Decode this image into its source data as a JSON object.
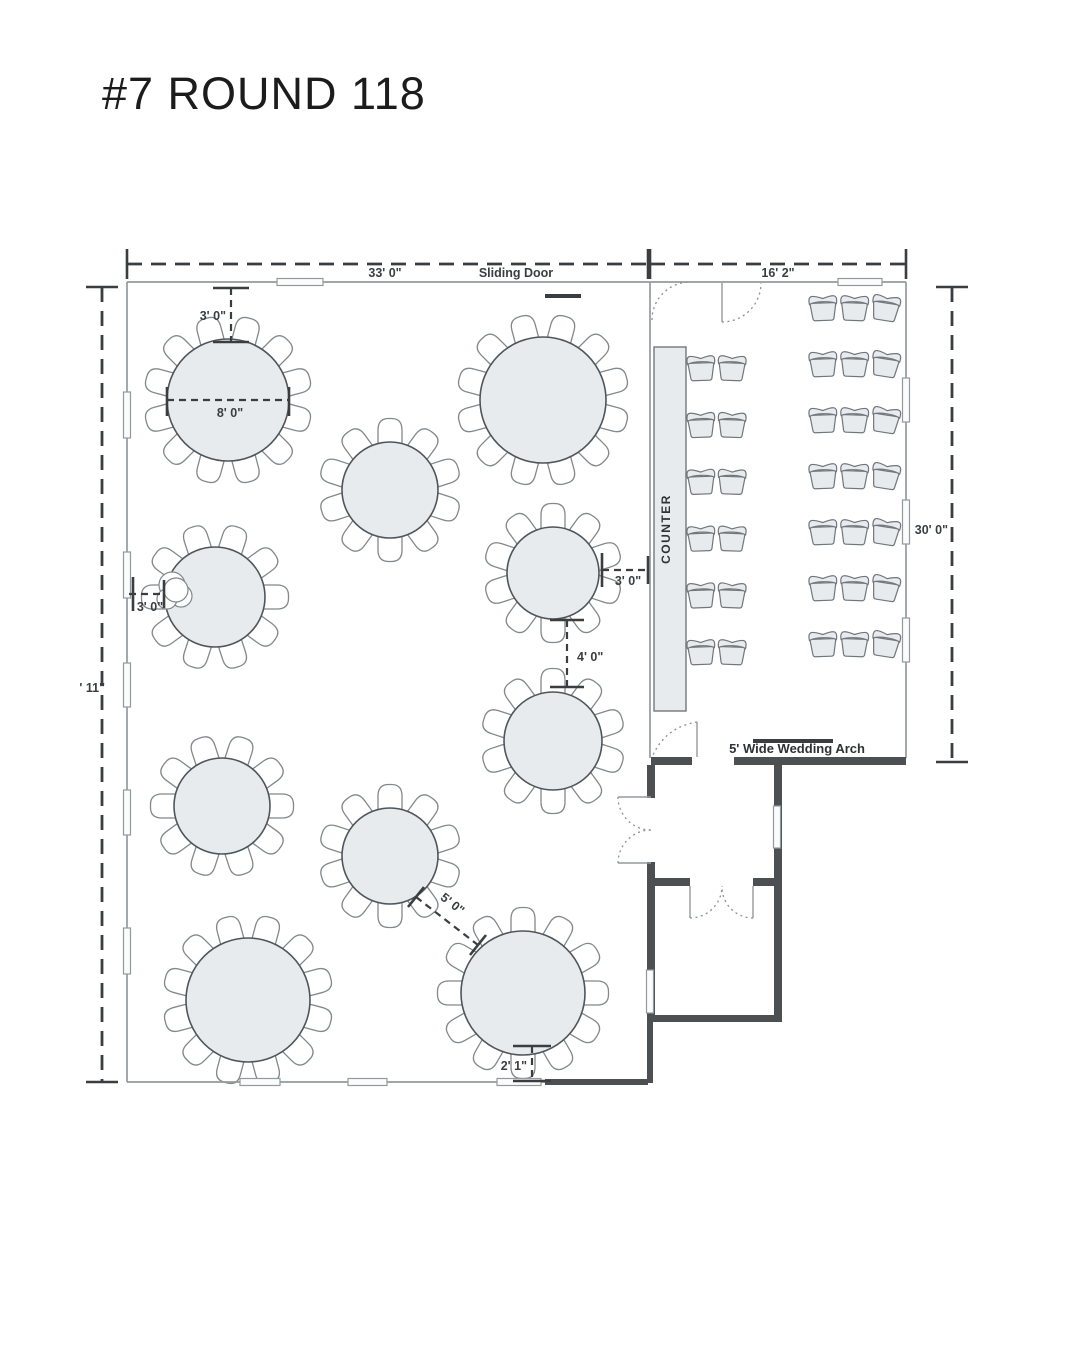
{
  "title": "#7 ROUND 118",
  "colors": {
    "wall_thin": "#939a9e",
    "wall_thick": "#4c5053",
    "table_fill": "#e7ebee",
    "table_stroke": "#4e565c",
    "chair_fill": "#ffffff",
    "chair_stroke": "#82888c",
    "ceremony_chair_fill": "#e7ebee",
    "ceremony_chair_stroke": "#70767b",
    "counter_fill": "#e7ebee",
    "counter_stroke": "#70777c",
    "window_fill": "#fbfcfc",
    "dim": "#3a3e41",
    "door_arc": "#8a9095"
  },
  "floorplan": {
    "tables": [
      {
        "cx": 228,
        "cy": 400,
        "r": 61,
        "chairs": 12,
        "start": -75
      },
      {
        "cx": 543,
        "cy": 400,
        "r": 63,
        "chairs": 12,
        "start": -75
      },
      {
        "cx": 390,
        "cy": 490,
        "r": 48,
        "chairs": 10,
        "start": -90
      },
      {
        "cx": 215,
        "cy": 597,
        "r": 50,
        "chairs": 10,
        "start": -108
      },
      {
        "cx": 553,
        "cy": 573,
        "r": 46,
        "chairs": 10,
        "start": -90
      },
      {
        "cx": 553,
        "cy": 741,
        "r": 49,
        "chairs": 10,
        "start": -90
      },
      {
        "cx": 222,
        "cy": 806,
        "r": 48,
        "chairs": 10,
        "start": -72
      },
      {
        "cx": 390,
        "cy": 856,
        "r": 48,
        "chairs": 10,
        "start": -90
      },
      {
        "cx": 248,
        "cy": 1000,
        "r": 62,
        "chairs": 12,
        "start": -75
      },
      {
        "cx": 523,
        "cy": 993,
        "r": 62,
        "chairs": 12,
        "start": -90
      }
    ],
    "cluster": [
      [
        172,
        585,
        13
      ],
      [
        181,
        596,
        11
      ],
      [
        167,
        599,
        10
      ],
      [
        176,
        590,
        12
      ]
    ],
    "chair_blocks": [
      {
        "x0": 701,
        "y0": 366,
        "cols": 2,
        "rows": 6,
        "dx": 31,
        "dy": 56.8,
        "tilt": [
          -2,
          2
        ]
      },
      {
        "x0": 823,
        "y0": 306,
        "cols": 3,
        "rows": 7,
        "dx": 31.5,
        "dy": 56,
        "tilt": [
          -2,
          2,
          9
        ]
      }
    ],
    "counter": {
      "x": 654,
      "y": 347,
      "w": 32,
      "h": 364,
      "label": "COUNTER",
      "lx": 670,
      "ly": 529
    },
    "thin_walls": [
      [
        127,
        282,
        650,
        282
      ],
      [
        127,
        282,
        127,
        1082
      ],
      [
        127,
        1082,
        546,
        1082
      ],
      [
        650,
        282,
        650,
        758
      ],
      [
        650,
        282,
        906,
        282
      ],
      [
        906,
        282,
        906,
        758
      ]
    ],
    "thick_walls": [
      [
        651,
        757,
        41,
        8
      ],
      [
        734,
        757,
        172,
        8
      ],
      [
        647,
        765,
        8,
        33
      ],
      [
        647,
        862,
        8,
        24
      ],
      [
        774,
        757,
        8,
        129
      ],
      [
        647,
        878,
        43,
        8
      ],
      [
        753,
        878,
        29,
        8
      ],
      [
        647,
        886,
        8,
        136
      ],
      [
        774,
        886,
        8,
        136
      ],
      [
        647,
        1015,
        135,
        7
      ],
      [
        647,
        1022,
        6,
        61
      ],
      [
        545,
        1079,
        103,
        6
      ]
    ],
    "windows": [
      [
        123.5,
        392,
        7,
        46
      ],
      [
        123.5,
        552,
        7,
        46
      ],
      [
        123.5,
        663,
        7,
        44
      ],
      [
        123.5,
        790,
        7,
        45
      ],
      [
        123.5,
        928,
        7,
        46
      ],
      [
        277,
        278.5,
        46,
        7
      ],
      [
        838,
        278.5,
        44,
        7
      ],
      [
        902.5,
        378,
        7,
        44
      ],
      [
        902.5,
        500,
        7,
        44
      ],
      [
        902.5,
        618,
        7,
        44
      ],
      [
        240,
        1078.5,
        40,
        7
      ],
      [
        348,
        1078.5,
        39,
        7
      ],
      [
        497,
        1078.5,
        44,
        7
      ],
      [
        773.5,
        806,
        7,
        42
      ],
      [
        646.5,
        970,
        7,
        43
      ]
    ],
    "bars": [
      [
        545,
        294,
        36,
        4
      ],
      [
        753,
        739,
        80,
        4
      ]
    ],
    "door_leaves": [
      [
        722,
        283,
        722,
        322
      ],
      [
        697,
        722,
        697,
        757
      ],
      [
        618,
        797,
        651,
        797
      ],
      [
        618,
        863,
        651,
        863
      ],
      [
        690,
        886,
        690,
        918
      ],
      [
        753,
        886,
        753,
        918
      ]
    ],
    "door_arcs": [
      "M652,320 A38,38 0 0 1 690,282",
      "M722,322 A39,39 0 0 0 761,283",
      "M697,722 Q666,727 653,755",
      "M618,797 A33,33 0 0 0 651,830",
      "M618,863 A33,33 0 0 1 651,830",
      "M690,918 A32,32 0 0 0 722,886",
      "M753,918 A31,31 0 0 1 722,886"
    ],
    "dimensions": [
      {
        "line": [
          127,
          264,
          648,
          264
        ],
        "big": true,
        "ticks": [
          [
            127,
            249,
            127,
            279
          ],
          [
            648,
            249,
            648,
            279
          ]
        ],
        "labels": [
          {
            "t": "33' 0\"",
            "x": 385,
            "y": 277,
            "anchor": "middle"
          },
          {
            "t": "Sliding Door",
            "x": 516,
            "y": 277,
            "anchor": "middle"
          }
        ]
      },
      {
        "line": [
          650,
          264,
          906,
          264
        ],
        "big": true,
        "ticks": [
          [
            650,
            249,
            650,
            279
          ],
          [
            906,
            249,
            906,
            279
          ]
        ],
        "labels": [
          {
            "t": "16' 2\"",
            "x": 778,
            "y": 277,
            "anchor": "middle"
          }
        ]
      },
      {
        "line": [
          952,
          287,
          952,
          762
        ],
        "big": true,
        "ticks": [
          [
            936,
            287,
            968,
            287
          ],
          [
            936,
            762,
            968,
            762
          ]
        ],
        "labels": [
          {
            "t": "30' 0\"",
            "x": 948,
            "y": 534,
            "anchor": "end"
          }
        ]
      },
      {
        "line": [
          102,
          287,
          102,
          1082
        ],
        "big": true,
        "ticks": [
          [
            86,
            287,
            118,
            287
          ],
          [
            86,
            1082,
            118,
            1082
          ]
        ],
        "labels": [
          {
            "t": "' 11\"",
            "x": 105,
            "y": 692,
            "anchor": "end"
          }
        ]
      },
      {
        "line": [
          231,
          288,
          231,
          342
        ],
        "big": false,
        "ticks": [
          [
            213,
            288,
            249,
            288
          ],
          [
            213,
            342,
            249,
            342
          ]
        ],
        "labels": [
          {
            "t": "3' 0\"",
            "x": 226,
            "y": 320,
            "anchor": "end"
          }
        ]
      },
      {
        "line": [
          167,
          400,
          289,
          400
        ],
        "big": false,
        "ticks": [
          [
            167,
            387,
            167,
            416
          ],
          [
            289,
            387,
            289,
            416
          ]
        ],
        "labels": [
          {
            "t": "8' 0\"",
            "x": 230,
            "y": 417,
            "anchor": "middle"
          }
        ]
      },
      {
        "line": [
          129,
          594,
          164,
          594
        ],
        "big": false,
        "ticks": [
          [
            133,
            577,
            133,
            611
          ],
          [
            164,
            580,
            164,
            608
          ]
        ],
        "labels": [
          {
            "t": "3' 0\"",
            "x": 150,
            "y": 611,
            "anchor": "middle"
          }
        ]
      },
      {
        "line": [
          602,
          570,
          650,
          570
        ],
        "big": false,
        "ticks": [
          [
            602,
            553,
            602,
            587
          ],
          [
            648,
            556,
            648,
            584
          ]
        ],
        "labels": [
          {
            "t": "3' 0\"",
            "x": 628,
            "y": 585,
            "anchor": "middle"
          }
        ]
      },
      {
        "line": [
          567,
          620,
          567,
          687
        ],
        "big": false,
        "ticks": [
          [
            550,
            620,
            584,
            620
          ],
          [
            550,
            687,
            584,
            687
          ]
        ],
        "labels": [
          {
            "t": "4' 0\"",
            "x": 577,
            "y": 661,
            "anchor": "start"
          }
        ]
      },
      {
        "line": [
          416,
          897,
          478,
          945
        ],
        "big": false,
        "ticks": [
          [
            408,
            907,
            424,
            887
          ],
          [
            470,
            955,
            486,
            935
          ]
        ],
        "labels": [
          {
            "t": "5' 0\"",
            "x": 450,
            "y": 907,
            "anchor": "middle",
            "rotate": 38
          }
        ]
      },
      {
        "line": [
          532,
          1046,
          532,
          1081
        ],
        "big": false,
        "ticks": [
          [
            513,
            1046,
            551,
            1046
          ],
          [
            513,
            1081,
            551,
            1081
          ]
        ],
        "labels": [
          {
            "t": "2' 1\"",
            "x": 527,
            "y": 1070,
            "anchor": "end"
          }
        ]
      }
    ],
    "arch_label": {
      "t": "5' Wide Wedding Arch",
      "x": 797,
      "y": 753,
      "anchor": "middle"
    }
  }
}
